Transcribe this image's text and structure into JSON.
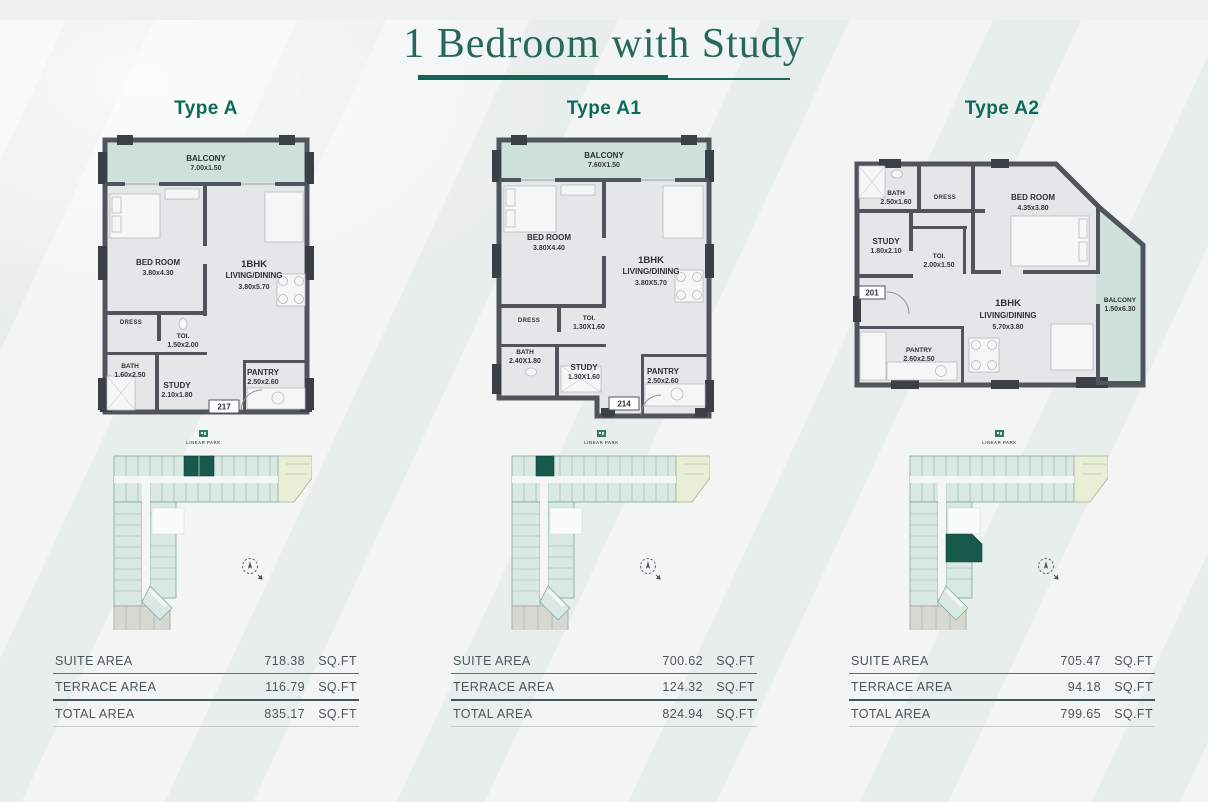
{
  "title": "1 Bedroom with Study",
  "keyplan_brand": "LINEAR PARK",
  "area_table_headers": {
    "suite": "SUITE AREA",
    "terrace": "TERRACE AREA",
    "total": "TOTAL AREA",
    "unit": "SQ.FT"
  },
  "colors": {
    "accent_teal": "#0d6a5b",
    "title_teal": "#26695b",
    "highlight_green": "#17594b",
    "wall_gray": "#4f555b",
    "glass_green": "#cfe1db",
    "keyplan_teal": "#d9e8e3",
    "keyplan_yellow": "#e9efd7",
    "keyplan_gray": "#d8d8d2"
  },
  "units": [
    {
      "type_label": "Type A",
      "unit_number": "217",
      "plan": {
        "balcony": {
          "name": "BALCONY",
          "dim": "7.00x1.50"
        },
        "bedroom": {
          "name": "BED ROOM",
          "dim": "3.80x4.30"
        },
        "living": {
          "name1": "1BHK",
          "name2": "LIVING/DINING",
          "dim": "3.80x5.70"
        },
        "dress": {
          "name": "DRESS"
        },
        "toilet": {
          "name": "TOI.",
          "dim": "1.50x2.00"
        },
        "bath": {
          "name": "BATH",
          "dim": "1.60x2.50"
        },
        "study": {
          "name": "STUDY",
          "dim": "2.10x1.80"
        },
        "pantry": {
          "name": "PANTRY",
          "dim": "2.50x2.60"
        }
      },
      "areas": {
        "suite": "718.38",
        "terrace": "116.79",
        "total": "835.17"
      }
    },
    {
      "type_label": "Type A1",
      "unit_number": "214",
      "plan": {
        "balcony": {
          "name": "BALCONY",
          "dim": "7.60X1.50"
        },
        "bedroom": {
          "name": "BED ROOM",
          "dim": "3.80X4.40"
        },
        "living": {
          "name1": "1BHK",
          "name2": "LIVING/DINING",
          "dim": "3.80X5.70"
        },
        "dress": {
          "name": "DRESS"
        },
        "toilet": {
          "name": "TOI.",
          "dim": "1.30X1.60"
        },
        "bath": {
          "name": "BATH",
          "dim": "2.40X1.80"
        },
        "study": {
          "name": "STUDY",
          "dim": "1.30X1.60"
        },
        "pantry": {
          "name": "PANTRY",
          "dim": "2.50x2.60"
        }
      },
      "areas": {
        "suite": "700.62",
        "terrace": "124.32",
        "total": "824.94"
      }
    },
    {
      "type_label": "Type A2",
      "unit_number": "201",
      "plan": {
        "balcony": {
          "name": "BALCONY",
          "dim": "1.50x6.30"
        },
        "bedroom": {
          "name": "BED ROOM",
          "dim": "4.35x3.80"
        },
        "living": {
          "name1": "1BHK",
          "name2": "LIVING/DINING",
          "dim": "5.70x3.80"
        },
        "dress": {
          "name": "DRESS"
        },
        "toilet": {
          "name": "TOI.",
          "dim": "2.00x1.50"
        },
        "bath": {
          "name": "BATH",
          "dim": "2.50x1.60"
        },
        "study": {
          "name": "STUDY",
          "dim": "1.80x2.10"
        },
        "pantry": {
          "name": "PANTRY",
          "dim": "2.60x2.50"
        }
      },
      "areas": {
        "suite": "705.47",
        "terrace": "94.18",
        "total": "799.65"
      }
    }
  ]
}
